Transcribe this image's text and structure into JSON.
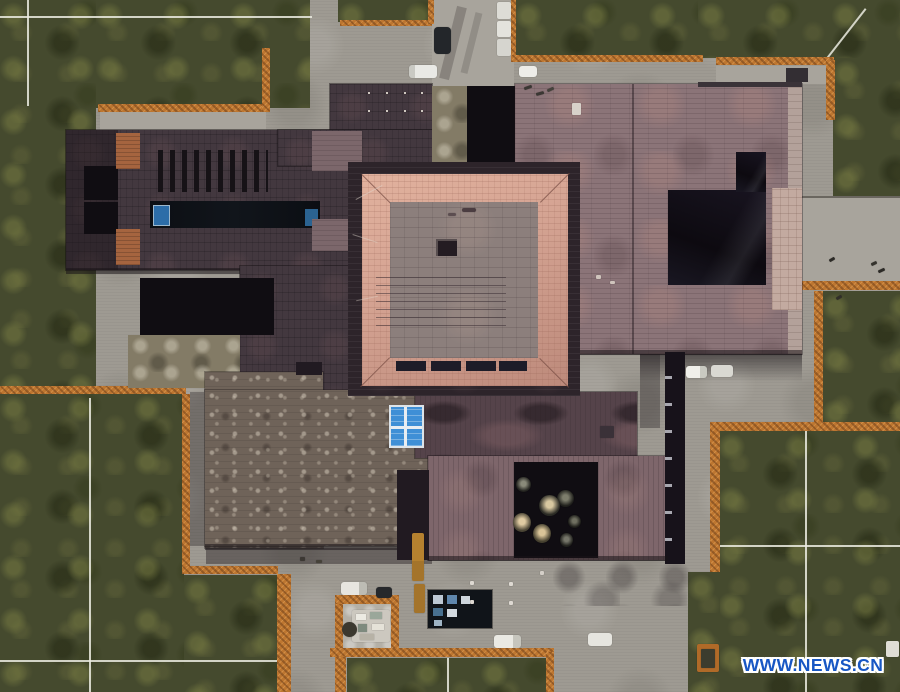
{
  "image": {
    "type": "aerial-photograph",
    "subject": "Top-down aerial view of a sprawling museum building complex with dark slate roofs, a central square hall framed by a pink hipped roof, rust-orange corten steel edging, lawns with white survey lines, concrete paths, parked vehicles and a sunken courtyard with round tree canopies"
  },
  "watermark": {
    "text": "WWW.NEWS.CN",
    "color": "#1857c4",
    "outline": "#ffffff"
  },
  "palette": {
    "grass": "#454a2e",
    "concrete": "#9e9a92",
    "concrete_light": "#aaa69e",
    "corten_orange": "#bd7630",
    "roof_plum": "#43383f",
    "roof_mauve": "#8b7478",
    "roof_pink_frame": "#d2a08f",
    "roof_inner_gray": "#8c7f7c",
    "roof_weathered": "#6f6359",
    "roof_marbled": "#55434a",
    "courtyard_black": "#131019",
    "skylight_blue": "#3c8ccd",
    "watermark_blue": "#1857c4"
  },
  "sprites": [
    {
      "n": "car-dark-north",
      "x": 434,
      "y": 27,
      "w": 17,
      "h": 27,
      "c": "#23262a",
      "r": 4
    },
    {
      "n": "van-white-north",
      "x": 409,
      "y": 65,
      "w": 28,
      "h": 13,
      "c": "linear-gradient(90deg,#c9c9c3 0 6px,#e9e9e5 6px)",
      "r": 3
    },
    {
      "n": "truck-white-north-1",
      "x": 497,
      "y": 2,
      "w": 14,
      "h": 17,
      "c": "#dddcd6",
      "r": 2
    },
    {
      "n": "truck-white-north-2",
      "x": 497,
      "y": 21,
      "w": 14,
      "h": 16,
      "c": "#e4e3dd",
      "r": 2
    },
    {
      "n": "truck-white-north-3",
      "x": 497,
      "y": 39,
      "w": 14,
      "h": 17,
      "c": "#d6d5cf",
      "r": 2
    },
    {
      "n": "car-white-north",
      "x": 519,
      "y": 66,
      "w": 18,
      "h": 11,
      "c": "#edece8",
      "r": 3
    },
    {
      "n": "car-white-east-1",
      "x": 686,
      "y": 366,
      "w": 21,
      "h": 12,
      "c": "linear-gradient(90deg,#f0efea 0 14px,#c9c9c1 14px)",
      "r": 3
    },
    {
      "n": "car-white-east-2",
      "x": 711,
      "y": 365,
      "w": 22,
      "h": 12,
      "c": "#d9d8d2",
      "r": 3
    },
    {
      "n": "car-white-southwest",
      "x": 341,
      "y": 582,
      "w": 26,
      "h": 13,
      "c": "linear-gradient(90deg,#e7e5df 0 18px,#bdbcb4 18px)",
      "r": 3
    },
    {
      "n": "car-dark-southwest",
      "x": 376,
      "y": 587,
      "w": 16,
      "h": 11,
      "c": "#26282b",
      "r": 3
    },
    {
      "n": "truck-orange-1",
      "x": 412,
      "y": 533,
      "w": 12,
      "h": 48,
      "c": "linear-gradient(0deg,#a4742b 0 20px,#b5812f 20px)",
      "r": 2
    },
    {
      "n": "truck-orange-2",
      "x": 414,
      "y": 584,
      "w": 11,
      "h": 29,
      "c": "#a4742b",
      "r": 2
    },
    {
      "n": "van-white-south-1",
      "x": 494,
      "y": 635,
      "w": 27,
      "h": 13,
      "c": "linear-gradient(90deg,#eae9e3 0 19px,#c6c5bd 19px)",
      "r": 3
    },
    {
      "n": "van-white-south-2",
      "x": 588,
      "y": 633,
      "w": 24,
      "h": 13,
      "c": "#e6e5df",
      "r": 3
    },
    {
      "n": "tree-canopy",
      "x": 516,
      "y": 477,
      "w": 15,
      "h": 15,
      "c1": "#8a8a7a",
      "c2": "#23231f",
      "r": "50%"
    },
    {
      "n": "tree-canopy",
      "x": 557,
      "y": 490,
      "w": 17,
      "h": 17,
      "c1": "#7d7d6c",
      "c2": "#1f1f1b",
      "r": "50%"
    },
    {
      "n": "tree-canopy",
      "x": 539,
      "y": 495,
      "w": 21,
      "h": 21,
      "c1": "#d8c8a0",
      "c2": "#2a2a24",
      "r": "50%"
    },
    {
      "n": "tree-canopy",
      "x": 568,
      "y": 515,
      "w": 13,
      "h": 13,
      "c1": "#6f6f60",
      "c2": "#1d1d19",
      "r": "50%"
    },
    {
      "n": "tree-canopy",
      "x": 513,
      "y": 513,
      "w": 18,
      "h": 19,
      "c1": "#e0cba2",
      "c2": "#4a4434",
      "r": "50%"
    },
    {
      "n": "tree-canopy",
      "x": 533,
      "y": 524,
      "w": 18,
      "h": 19,
      "c1": "#d9c498",
      "c2": "#45402f",
      "r": "50%"
    },
    {
      "n": "tree-canopy",
      "x": 560,
      "y": 533,
      "w": 13,
      "h": 14,
      "c1": "#76766a",
      "c2": "#20201c",
      "r": "50%"
    },
    {
      "n": "pedestrian-mark",
      "x": 829,
      "y": 258,
      "w": 6,
      "h": 3,
      "c": "#2c2a26",
      "r": 1,
      "rot": -30
    },
    {
      "n": "pedestrian-mark",
      "x": 871,
      "y": 262,
      "w": 6,
      "h": 3,
      "c": "#34322c",
      "r": 1,
      "rot": -25
    },
    {
      "n": "pedestrian-mark",
      "x": 878,
      "y": 269,
      "w": 7,
      "h": 3,
      "c": "#2c2a26",
      "r": 1,
      "rot": -25
    },
    {
      "n": "pedestrian-mark",
      "x": 836,
      "y": 296,
      "w": 6,
      "h": 3,
      "c": "#302e29",
      "r": 1,
      "rot": -30
    },
    {
      "n": "pedestrian-mark",
      "x": 524,
      "y": 86,
      "w": 8,
      "h": 3,
      "c": "#3a3733",
      "r": 1,
      "rot": -20
    },
    {
      "n": "pedestrian-mark",
      "x": 536,
      "y": 92,
      "w": 8,
      "h": 3,
      "c": "#3a3733",
      "r": 1,
      "rot": -15
    },
    {
      "n": "pedestrian-mark",
      "x": 547,
      "y": 88,
      "w": 7,
      "h": 3,
      "c": "#45423c",
      "r": 1,
      "rot": -25
    },
    {
      "n": "rubble-mark",
      "x": 300,
      "y": 557,
      "w": 5,
      "h": 4,
      "c": "#3c3833",
      "r": 1
    },
    {
      "n": "rubble-mark",
      "x": 316,
      "y": 560,
      "w": 6,
      "h": 3,
      "c": "#464239",
      "r": 1
    },
    {
      "n": "roof-mark",
      "x": 470,
      "y": 581,
      "w": 4,
      "h": 4,
      "c": "#ded9d2",
      "r": 1
    },
    {
      "n": "roof-mark",
      "x": 509,
      "y": 582,
      "w": 4,
      "h": 4,
      "c": "#ded9d2",
      "r": 1
    },
    {
      "n": "roof-mark",
      "x": 470,
      "y": 600,
      "w": 4,
      "h": 4,
      "c": "#ded9d2",
      "r": 1
    },
    {
      "n": "roof-mark",
      "x": 509,
      "y": 601,
      "w": 4,
      "h": 4,
      "c": "#ded9d2",
      "r": 1
    },
    {
      "n": "roof-mark",
      "x": 540,
      "y": 571,
      "w": 4,
      "h": 4,
      "c": "#d4cfc8",
      "r": 1
    },
    {
      "n": "roof-mark",
      "x": 596,
      "y": 275,
      "w": 5,
      "h": 4,
      "c": "#cfc4bc",
      "r": 1
    },
    {
      "n": "roof-mark",
      "x": 610,
      "y": 281,
      "w": 5,
      "h": 3,
      "c": "#cfc4bc",
      "r": 1
    },
    {
      "n": "roof-vent-box",
      "x": 572,
      "y": 103,
      "w": 9,
      "h": 12,
      "c": "#d8d2ca",
      "r": 1
    },
    {
      "n": "roof-vent-dark",
      "x": 600,
      "y": 426,
      "w": 14,
      "h": 12,
      "c": "#3a3138",
      "r": 1
    },
    {
      "n": "roof-smudge",
      "x": 462,
      "y": 208,
      "w": 14,
      "h": 4,
      "c": "rgba(58,44,50,.8)",
      "r": 2
    },
    {
      "n": "roof-smudge",
      "x": 448,
      "y": 213,
      "w": 8,
      "h": 3,
      "c": "rgba(58,44,50,.6)",
      "r": 2
    },
    {
      "n": "rivet-dot",
      "x": 368,
      "y": 92,
      "w": 2,
      "h": 2,
      "c": "#cfc8c0"
    },
    {
      "n": "rivet-dot",
      "x": 386,
      "y": 92,
      "w": 2,
      "h": 2,
      "c": "#cfc8c0"
    },
    {
      "n": "rivet-dot",
      "x": 404,
      "y": 92,
      "w": 2,
      "h": 2,
      "c": "#cfc8c0"
    },
    {
      "n": "rivet-dot",
      "x": 421,
      "y": 92,
      "w": 2,
      "h": 2,
      "c": "#cfc8c0"
    },
    {
      "n": "rivet-dot",
      "x": 368,
      "y": 110,
      "w": 2,
      "h": 2,
      "c": "#cfc8c0"
    },
    {
      "n": "rivet-dot",
      "x": 386,
      "y": 110,
      "w": 2,
      "h": 2,
      "c": "#cfc8c0"
    },
    {
      "n": "rivet-dot",
      "x": 404,
      "y": 110,
      "w": 2,
      "h": 2,
      "c": "#cfc8c0"
    },
    {
      "n": "rivet-dot",
      "x": 421,
      "y": 110,
      "w": 2,
      "h": 2,
      "c": "#cfc8c0"
    },
    {
      "n": "material-stack",
      "x": 352,
      "y": 610,
      "w": 38,
      "h": 32,
      "c": "#ccc8bf",
      "r": 2
    },
    {
      "n": "material-item",
      "x": 356,
      "y": 614,
      "w": 10,
      "h": 6,
      "c": "#eceae2"
    },
    {
      "n": "material-item",
      "x": 370,
      "y": 612,
      "w": 12,
      "h": 7,
      "c": "#9aa79a"
    },
    {
      "n": "material-item",
      "x": 358,
      "y": 624,
      "w": 9,
      "h": 8,
      "c": "#7e8a7e"
    },
    {
      "n": "material-item",
      "x": 372,
      "y": 624,
      "w": 12,
      "h": 6,
      "c": "#e5e2d8"
    },
    {
      "n": "material-item",
      "x": 360,
      "y": 634,
      "w": 14,
      "h": 6,
      "c": "#b7b2a6"
    },
    {
      "n": "barrel-dark",
      "x": 342,
      "y": 622,
      "w": 15,
      "h": 15,
      "c": "#3b382f",
      "r": "50%"
    },
    {
      "n": "glass-cell",
      "x": 433,
      "y": 595,
      "w": 10,
      "h": 9,
      "c": "#bcc8d4"
    },
    {
      "n": "glass-cell",
      "x": 447,
      "y": 595,
      "w": 10,
      "h": 9,
      "c": "#5f86ac"
    },
    {
      "n": "glass-cell",
      "x": 461,
      "y": 596,
      "w": 9,
      "h": 8,
      "c": "#cdd5dc"
    },
    {
      "n": "glass-cell",
      "x": 433,
      "y": 608,
      "w": 10,
      "h": 8,
      "c": "#48708f"
    },
    {
      "n": "glass-cell",
      "x": 447,
      "y": 609,
      "w": 10,
      "h": 8,
      "c": "#d2d9df"
    },
    {
      "n": "glass-cell",
      "x": 434,
      "y": 620,
      "w": 8,
      "h": 6,
      "c": "#9fb4c4"
    },
    {
      "n": "planter-orange",
      "x": 697,
      "y": 644,
      "w": 22,
      "h": 28,
      "c": "#b06a28",
      "r": 2
    },
    {
      "n": "planter-inner",
      "x": 701,
      "y": 649,
      "w": 14,
      "h": 19,
      "c": "#3c3c2e",
      "r": 1
    },
    {
      "n": "white-box-southeast",
      "x": 886,
      "y": 641,
      "w": 13,
      "h": 16,
      "c": "#dfddd5",
      "r": 2
    }
  ]
}
